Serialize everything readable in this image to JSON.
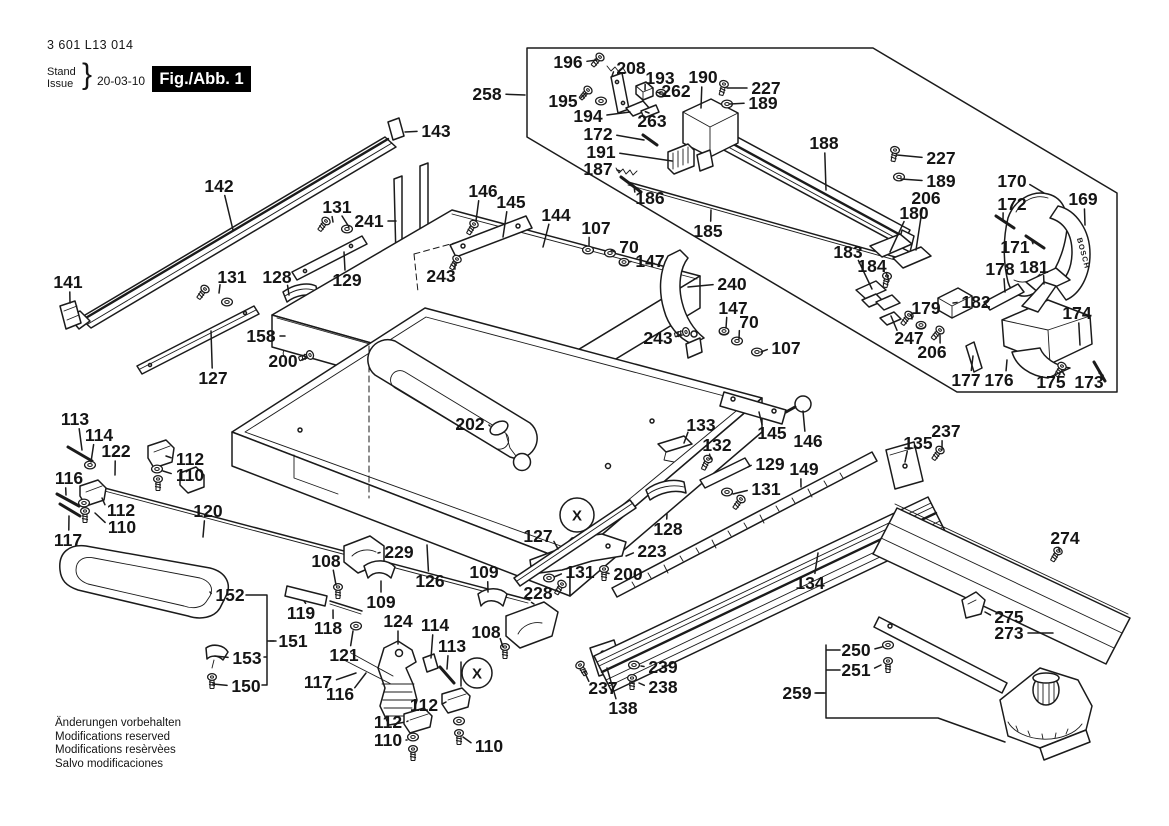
{
  "title_block": {
    "part_number": "3 601 L13 014",
    "stand_label": "Stand",
    "issue_label": "Issue",
    "brace": "}",
    "date": "20-03-10",
    "figure_label": "Fig./Abb. 1"
  },
  "footer": {
    "lines": [
      "Änderungen vorbehalten",
      "Modifications reserved",
      "Modifications resèrvèes",
      "Salvo modificaciones"
    ]
  },
  "diagram": {
    "handle_brand": "BOSCH",
    "colors": {
      "ink": "#1b1b1b",
      "background": "#ffffff"
    },
    "callouts": [
      {
        "t": "258",
        "x": 487,
        "y": 94,
        "lx": 525,
        "ly": 95
      },
      {
        "t": "196",
        "x": 568,
        "y": 62,
        "lx": 597,
        "ly": 60
      },
      {
        "t": "208",
        "x": 631,
        "y": 68,
        "lx": 612,
        "ly": 76
      },
      {
        "t": "193",
        "x": 660,
        "y": 78,
        "lx": 645,
        "ly": 90
      },
      {
        "t": "190",
        "x": 703,
        "y": 77,
        "lx": 701,
        "ly": 108
      },
      {
        "t": "227",
        "x": 766,
        "y": 88,
        "lx": 727,
        "ly": 88
      },
      {
        "t": "189",
        "x": 763,
        "y": 103,
        "lx": 730,
        "ly": 104
      },
      {
        "t": "195",
        "x": 563,
        "y": 101,
        "lx": 586,
        "ly": 93
      },
      {
        "t": "194",
        "x": 588,
        "y": 116,
        "lx": 630,
        "ly": 112
      },
      {
        "t": "262",
        "x": 676,
        "y": 91,
        "lx": 661,
        "ly": 93
      },
      {
        "t": "263",
        "x": 652,
        "y": 121,
        "lx": 649,
        "ly": 113
      },
      {
        "t": "172",
        "x": 598,
        "y": 134,
        "lx": 644,
        "ly": 140
      },
      {
        "t": "191",
        "x": 601,
        "y": 152,
        "lx": 672,
        "ly": 161
      },
      {
        "t": "187",
        "x": 598,
        "y": 169,
        "lx": 620,
        "ly": 171
      },
      {
        "t": "186",
        "x": 650,
        "y": 198,
        "lx": 634,
        "ly": 186
      },
      {
        "t": "188",
        "x": 824,
        "y": 143,
        "lx": 826,
        "ly": 190
      },
      {
        "t": "227",
        "x": 941,
        "y": 158,
        "lx": 897,
        "ly": 155
      },
      {
        "t": "189",
        "x": 941,
        "y": 181,
        "lx": 901,
        "ly": 179
      },
      {
        "t": "206",
        "x": 926,
        "y": 198,
        "lx": 916,
        "ly": 250
      },
      {
        "t": "180",
        "x": 914,
        "y": 213,
        "lx": 890,
        "ly": 252
      },
      {
        "t": "183",
        "x": 848,
        "y": 252,
        "lx": 872,
        "ly": 289
      },
      {
        "t": "184",
        "x": 872,
        "y": 266,
        "lx": 889,
        "ly": 281
      },
      {
        "t": "170",
        "x": 1012,
        "y": 181,
        "lx": 1044,
        "ly": 193
      },
      {
        "t": "172",
        "x": 1012,
        "y": 204,
        "lx": 1003,
        "ly": 221
      },
      {
        "t": "169",
        "x": 1083,
        "y": 199,
        "lx": 1085,
        "ly": 225
      },
      {
        "t": "171",
        "x": 1015,
        "y": 247,
        "lx": 1032,
        "ly": 241
      },
      {
        "t": "178",
        "x": 1000,
        "y": 269,
        "lx": 1005,
        "ly": 292
      },
      {
        "t": "181",
        "x": 1034,
        "y": 267,
        "lx": 1044,
        "ly": 284
      },
      {
        "t": "182",
        "x": 976,
        "y": 302,
        "lx": 953,
        "ly": 303
      },
      {
        "t": "179",
        "x": 926,
        "y": 308,
        "lx": 912,
        "ly": 319
      },
      {
        "t": "247",
        "x": 909,
        "y": 338,
        "lx": 891,
        "ly": 316
      },
      {
        "t": "206",
        "x": 932,
        "y": 352,
        "lx": 940,
        "ly": 335
      },
      {
        "t": "174",
        "x": 1077,
        "y": 313,
        "lx": 1080,
        "ly": 345
      },
      {
        "t": "177",
        "x": 966,
        "y": 380,
        "lx": 973,
        "ly": 356
      },
      {
        "t": "176",
        "x": 999,
        "y": 380,
        "lx": 1007,
        "ly": 360
      },
      {
        "t": "175",
        "x": 1051,
        "y": 382,
        "lx": 1062,
        "ly": 371
      },
      {
        "t": "173",
        "x": 1089,
        "y": 382,
        "lx": 1099,
        "ly": 373
      },
      {
        "t": "143",
        "x": 436,
        "y": 131,
        "lx": 405,
        "ly": 132
      },
      {
        "t": "142",
        "x": 219,
        "y": 186,
        "lx": 233,
        "ly": 230
      },
      {
        "t": "131",
        "x": 337,
        "y": 207,
        "lx": 333,
        "ly": 222
      },
      {
        "t": "241",
        "x": 369,
        "y": 221,
        "lx": 396,
        "ly": 221
      },
      {
        "t": "146",
        "x": 483,
        "y": 191,
        "lx": 476,
        "ly": 221
      },
      {
        "t": "145",
        "x": 511,
        "y": 202,
        "lx": 503,
        "ly": 237
      },
      {
        "t": "144",
        "x": 556,
        "y": 215,
        "lx": 543,
        "ly": 247
      },
      {
        "t": "107",
        "x": 596,
        "y": 228,
        "lx": 589,
        "ly": 246
      },
      {
        "t": "70",
        "x": 629,
        "y": 247,
        "lx": 615,
        "ly": 252
      },
      {
        "t": "147",
        "x": 650,
        "y": 261,
        "lx": 629,
        "ly": 262
      },
      {
        "t": "185",
        "x": 708,
        "y": 231,
        "lx": 711,
        "ly": 210
      },
      {
        "t": "243",
        "x": 441,
        "y": 276,
        "lx": 455,
        "ly": 263
      },
      {
        "t": "141",
        "x": 68,
        "y": 282,
        "lx": 70,
        "ly": 303
      },
      {
        "t": "131",
        "x": 232,
        "y": 277,
        "lx": 219,
        "ly": 293
      },
      {
        "t": "128",
        "x": 277,
        "y": 277,
        "lx": 289,
        "ly": 295
      },
      {
        "t": "129",
        "x": 347,
        "y": 280,
        "lx": 344,
        "ly": 252
      },
      {
        "t": "158",
        "x": 261,
        "y": 336,
        "lx": 285,
        "ly": 336
      },
      {
        "t": "200",
        "x": 283,
        "y": 361,
        "lx": 306,
        "ly": 358
      },
      {
        "t": "127",
        "x": 213,
        "y": 378,
        "lx": 211,
        "ly": 331
      },
      {
        "t": "240",
        "x": 732,
        "y": 284,
        "lx": 688,
        "ly": 287
      },
      {
        "t": "147",
        "x": 733,
        "y": 308,
        "lx": 726,
        "ly": 328
      },
      {
        "t": "70",
        "x": 749,
        "y": 322,
        "lx": 739,
        "ly": 339
      },
      {
        "t": "107",
        "x": 786,
        "y": 348,
        "lx": 761,
        "ly": 352
      },
      {
        "t": "243",
        "x": 658,
        "y": 338,
        "lx": 681,
        "ly": 334
      },
      {
        "t": "202",
        "x": 470,
        "y": 424,
        "lx": 490,
        "ly": 426
      },
      {
        "t": "133",
        "x": 701,
        "y": 425,
        "lx": 684,
        "ly": 443
      },
      {
        "t": "132",
        "x": 717,
        "y": 445,
        "lx": 711,
        "ly": 459
      },
      {
        "t": "145",
        "x": 772,
        "y": 433,
        "lx": 759,
        "ly": 412
      },
      {
        "t": "146",
        "x": 808,
        "y": 441,
        "lx": 803,
        "ly": 411
      },
      {
        "t": "135",
        "x": 918,
        "y": 443,
        "lx": 905,
        "ly": 462
      },
      {
        "t": "237",
        "x": 946,
        "y": 431,
        "lx": 942,
        "ly": 450
      },
      {
        "t": "129",
        "x": 770,
        "y": 464,
        "lx": 748,
        "ly": 467
      },
      {
        "t": "131",
        "x": 766,
        "y": 489,
        "lx": 733,
        "ly": 494
      },
      {
        "t": "149",
        "x": 804,
        "y": 469,
        "lx": 801,
        "ly": 487
      },
      {
        "t": "127",
        "x": 538,
        "y": 536,
        "lx": 558,
        "ly": 549
      },
      {
        "t": "128",
        "x": 668,
        "y": 529,
        "lx": 667,
        "ly": 514
      },
      {
        "t": "223",
        "x": 652,
        "y": 551,
        "lx": 626,
        "ly": 556
      },
      {
        "t": "200",
        "x": 628,
        "y": 574,
        "lx": 607,
        "ly": 573
      },
      {
        "t": "131",
        "x": 580,
        "y": 572,
        "lx": 554,
        "ly": 577
      },
      {
        "t": "228",
        "x": 538,
        "y": 593,
        "lx": 534,
        "ly": 604
      },
      {
        "t": "126",
        "x": 430,
        "y": 581,
        "lx": 427,
        "ly": 545
      },
      {
        "t": "109",
        "x": 484,
        "y": 572,
        "lx": 488,
        "ly": 592
      },
      {
        "t": "108",
        "x": 486,
        "y": 632,
        "lx": 503,
        "ly": 647
      },
      {
        "t": "134",
        "x": 810,
        "y": 583,
        "lx": 818,
        "ly": 553
      },
      {
        "t": "274",
        "x": 1065,
        "y": 538,
        "lx": 1060,
        "ly": 552
      },
      {
        "t": "275",
        "x": 1009,
        "y": 617,
        "lx": 985,
        "ly": 612
      },
      {
        "t": "273",
        "x": 1009,
        "y": 633,
        "lx": 1053,
        "ly": 633
      },
      {
        "t": "113",
        "x": 75,
        "y": 419,
        "lx": 82,
        "ly": 450
      },
      {
        "t": "114",
        "x": 99,
        "y": 435,
        "lx": 91,
        "ly": 462
      },
      {
        "t": "122",
        "x": 116,
        "y": 451,
        "lx": 115,
        "ly": 475
      },
      {
        "t": "116",
        "x": 69,
        "y": 478,
        "lx": 66,
        "ly": 495
      },
      {
        "t": "112",
        "x": 190,
        "y": 459,
        "lx": 166,
        "ly": 456
      },
      {
        "t": "110",
        "x": 190,
        "y": 475,
        "lx": 163,
        "ly": 471
      },
      {
        "t": "112",
        "x": 121,
        "y": 510,
        "lx": 102,
        "ly": 498
      },
      {
        "t": "110",
        "x": 122,
        "y": 527,
        "lx": 95,
        "ly": 513
      },
      {
        "t": "117",
        "x": 68,
        "y": 540,
        "lx": 69,
        "ly": 516
      },
      {
        "t": "120",
        "x": 208,
        "y": 511,
        "lx": 203,
        "ly": 537
      },
      {
        "t": "108",
        "x": 326,
        "y": 561,
        "lx": 336,
        "ly": 585
      },
      {
        "t": "229",
        "x": 399,
        "y": 552,
        "lx": 378,
        "ly": 553
      },
      {
        "t": "109",
        "x": 381,
        "y": 602,
        "lx": 381,
        "ly": 581
      },
      {
        "t": "152",
        "x": 230,
        "y": 595,
        "lx": 210,
        "ly": 592
      },
      {
        "t": "119",
        "x": 301,
        "y": 613,
        "lx": 304,
        "ly": 601
      },
      {
        "t": "118",
        "x": 328,
        "y": 628,
        "lx": 333,
        "ly": 610
      },
      {
        "t": "151",
        "x": 293,
        "y": 641,
        "lx": 270,
        "ly": 641
      },
      {
        "t": "153",
        "x": 247,
        "y": 658,
        "lx": 215,
        "ly": 656
      },
      {
        "t": "150",
        "x": 246,
        "y": 686,
        "lx": 213,
        "ly": 684
      },
      {
        "t": "121",
        "x": 344,
        "y": 655,
        "lx": 353,
        "ly": 631
      },
      {
        "t": "124",
        "x": 398,
        "y": 621,
        "lx": 398,
        "ly": 644
      },
      {
        "t": "114",
        "x": 435,
        "y": 625,
        "lx": 431,
        "ly": 658
      },
      {
        "t": "113",
        "x": 452,
        "y": 646,
        "lx": 447,
        "ly": 669
      },
      {
        "t": "117",
        "x": 318,
        "y": 682,
        "lx": 356,
        "ly": 673
      },
      {
        "t": "116",
        "x": 340,
        "y": 694,
        "lx": 366,
        "ly": 673
      },
      {
        "t": "112",
        "x": 424,
        "y": 705,
        "lx": 446,
        "ly": 702
      },
      {
        "t": "112",
        "x": 388,
        "y": 722,
        "lx": 408,
        "ly": 721
      },
      {
        "t": "110",
        "x": 388,
        "y": 740,
        "lx": 406,
        "ly": 740
      },
      {
        "t": "110",
        "x": 489,
        "y": 746,
        "lx": 463,
        "ly": 737
      },
      {
        "t": "237",
        "x": 603,
        "y": 688,
        "lx": 584,
        "ly": 671
      },
      {
        "t": "138",
        "x": 623,
        "y": 708,
        "lx": 607,
        "ly": 668
      },
      {
        "t": "239",
        "x": 663,
        "y": 667,
        "lx": 641,
        "ly": 666
      },
      {
        "t": "238",
        "x": 663,
        "y": 687,
        "lx": 639,
        "ly": 683
      },
      {
        "t": "250",
        "x": 856,
        "y": 650,
        "lx": 882,
        "ly": 647
      },
      {
        "t": "251",
        "x": 856,
        "y": 670,
        "lx": 881,
        "ly": 665
      },
      {
        "t": "259",
        "x": 797,
        "y": 693,
        "lx": 824,
        "ly": 693
      }
    ],
    "markers": [
      {
        "t": "X",
        "x": 577,
        "y": 515,
        "r": 17
      },
      {
        "t": "X",
        "x": 477,
        "y": 673,
        "r": 15
      }
    ]
  }
}
